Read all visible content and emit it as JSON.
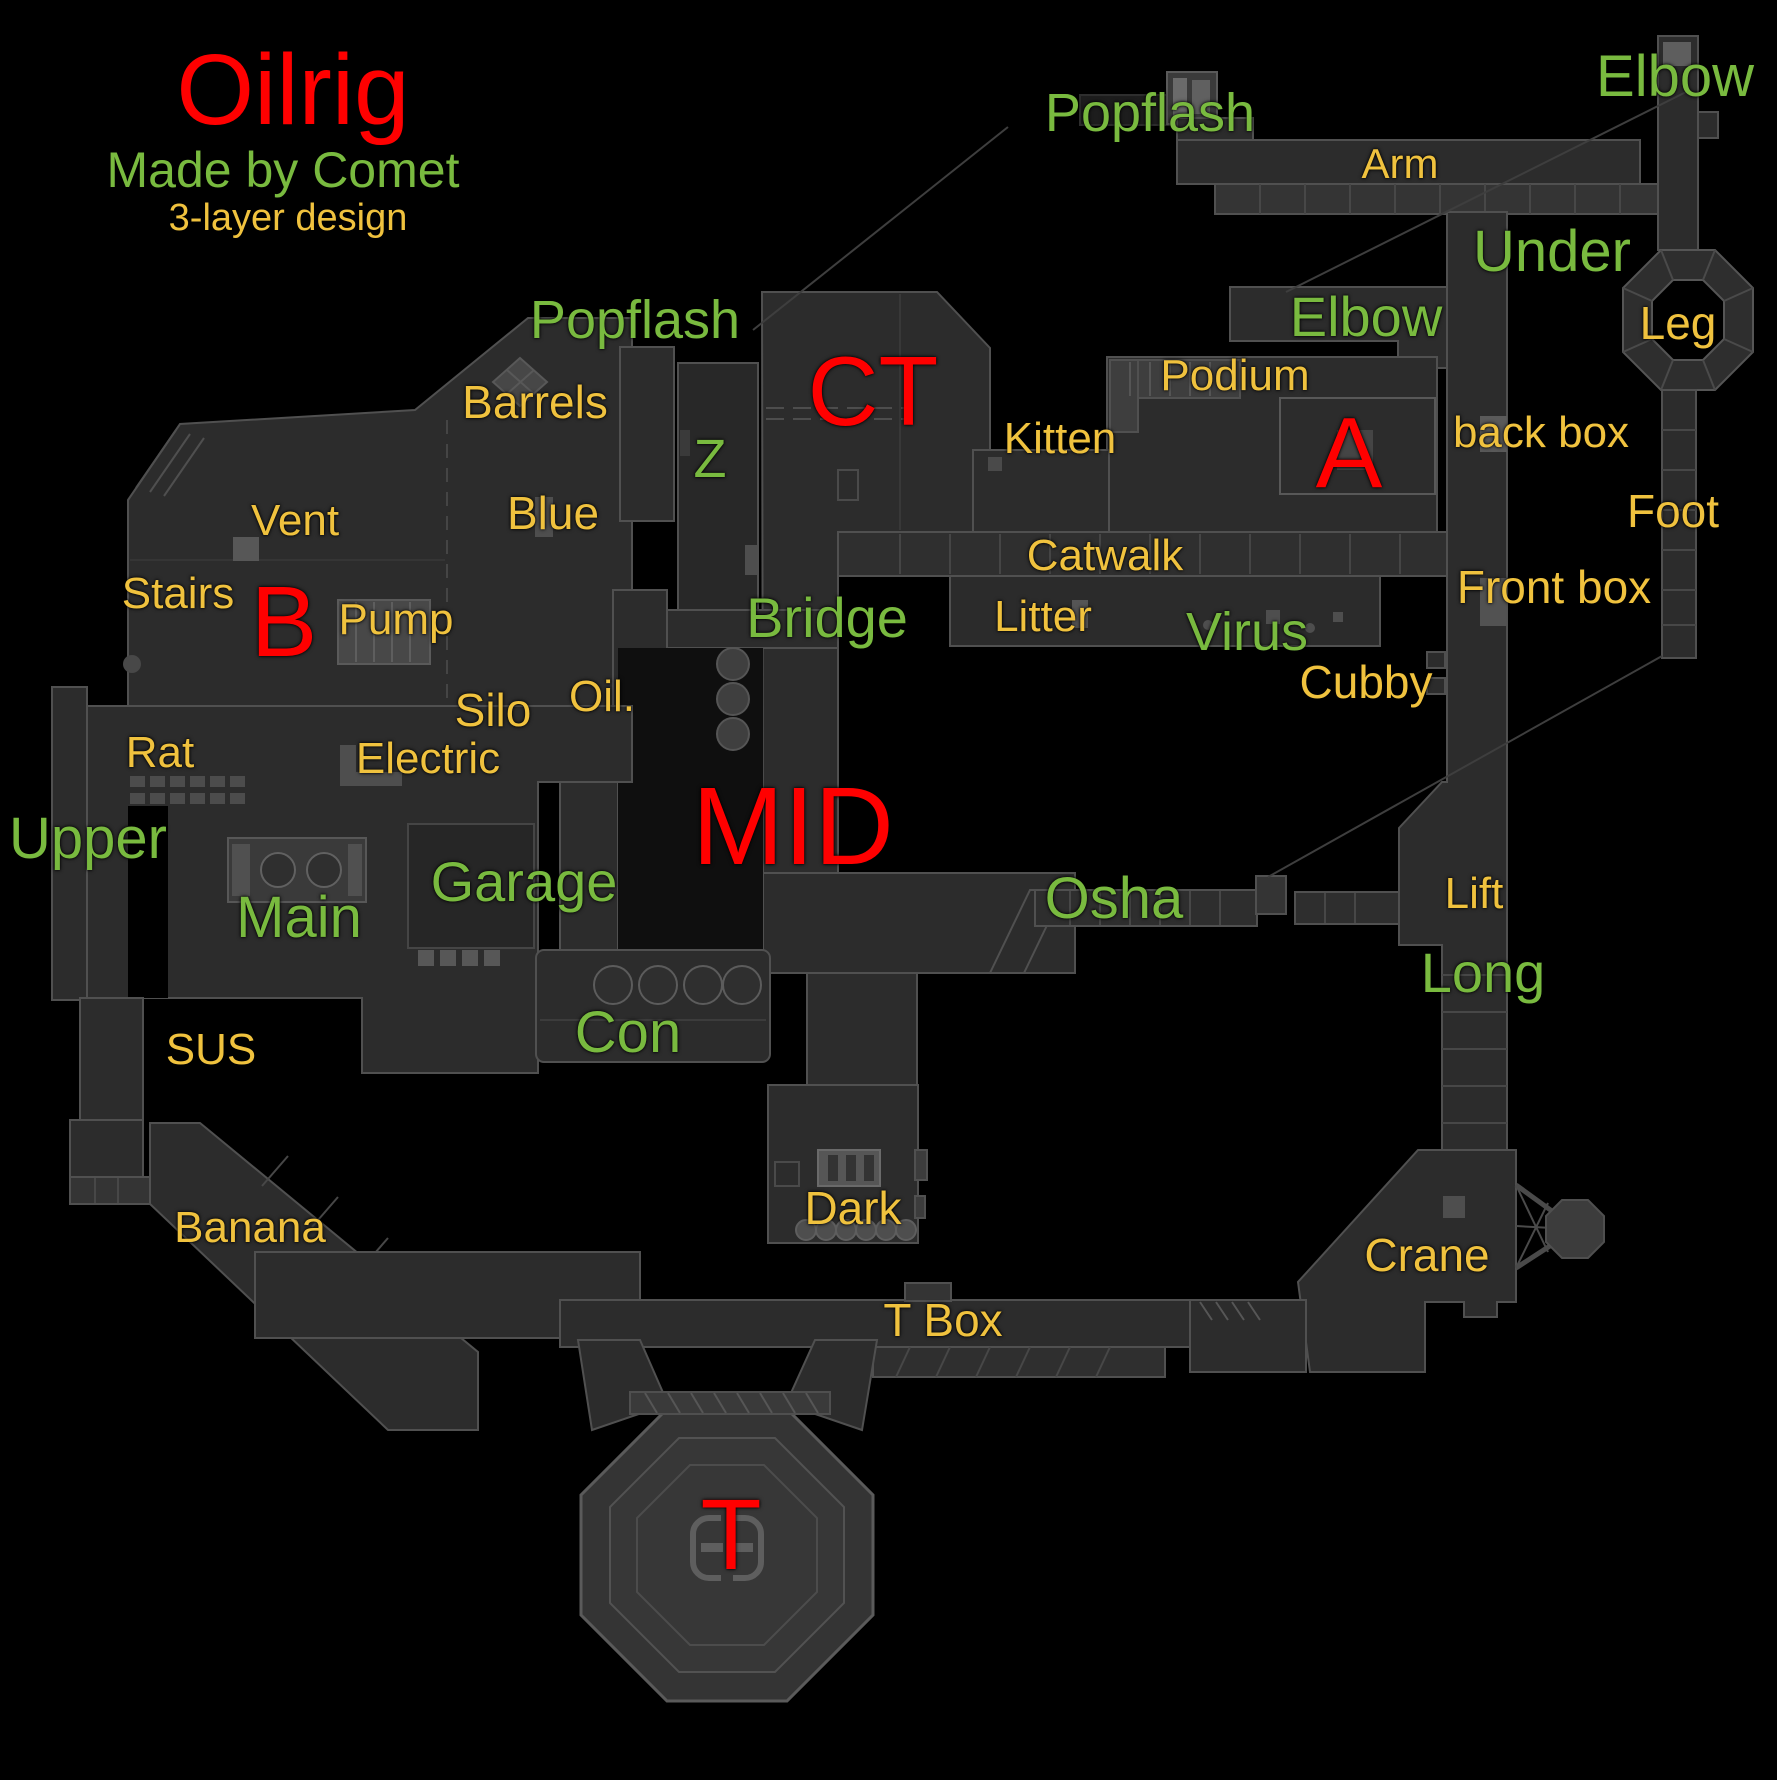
{
  "colors": {
    "red": "#FF0000",
    "green": "#79BA3F",
    "gold": "#F0C23E",
    "pointer_line": "#3E3E3E"
  },
  "labels": [
    {
      "id": "title",
      "text": "Oilrig",
      "color": "red",
      "x": 293,
      "y": 90,
      "size": 100
    },
    {
      "id": "credit",
      "text": "Made by Comet",
      "color": "green",
      "x": 283,
      "y": 170,
      "size": 50
    },
    {
      "id": "design-note",
      "text": "3-layer design",
      "color": "gold",
      "x": 288,
      "y": 218,
      "size": 38
    },
    {
      "id": "popflash-top",
      "text": "Popflash",
      "color": "green",
      "x": 1150,
      "y": 113,
      "size": 54
    },
    {
      "id": "arm",
      "text": "Arm",
      "color": "gold",
      "x": 1400,
      "y": 164,
      "size": 42
    },
    {
      "id": "elbow-top",
      "text": "Elbow",
      "color": "green",
      "x": 1675,
      "y": 77,
      "size": 58
    },
    {
      "id": "under",
      "text": "Under",
      "color": "green",
      "x": 1552,
      "y": 252,
      "size": 58
    },
    {
      "id": "leg",
      "text": "Leg",
      "color": "gold",
      "x": 1678,
      "y": 323,
      "size": 46
    },
    {
      "id": "elbow-a",
      "text": "Elbow",
      "color": "green",
      "x": 1366,
      "y": 317,
      "size": 56
    },
    {
      "id": "popflash-left",
      "text": "Popflash",
      "color": "green",
      "x": 635,
      "y": 320,
      "size": 54
    },
    {
      "id": "ct",
      "text": "CT",
      "color": "red",
      "x": 873,
      "y": 391,
      "size": 98
    },
    {
      "id": "podium",
      "text": "Podium",
      "color": "gold",
      "x": 1235,
      "y": 376,
      "size": 44
    },
    {
      "id": "kitten",
      "text": "Kitten",
      "color": "gold",
      "x": 1060,
      "y": 439,
      "size": 44
    },
    {
      "id": "a-site",
      "text": "A",
      "color": "red",
      "x": 1349,
      "y": 453,
      "size": 100
    },
    {
      "id": "back-box",
      "text": "back box",
      "color": "gold",
      "x": 1541,
      "y": 433,
      "size": 44
    },
    {
      "id": "foot",
      "text": "Foot",
      "color": "gold",
      "x": 1673,
      "y": 511,
      "size": 46
    },
    {
      "id": "z",
      "text": "Z",
      "color": "green",
      "x": 710,
      "y": 459,
      "size": 54
    },
    {
      "id": "barrels",
      "text": "Barrels",
      "color": "gold",
      "x": 535,
      "y": 402,
      "size": 46
    },
    {
      "id": "blue",
      "text": "Blue",
      "color": "gold",
      "x": 553,
      "y": 513,
      "size": 46
    },
    {
      "id": "vent",
      "text": "Vent",
      "color": "gold",
      "x": 295,
      "y": 521,
      "size": 44
    },
    {
      "id": "stairs",
      "text": "Stairs",
      "color": "gold",
      "x": 178,
      "y": 594,
      "size": 44
    },
    {
      "id": "b-site",
      "text": "B",
      "color": "red",
      "x": 284,
      "y": 622,
      "size": 100
    },
    {
      "id": "pump",
      "text": "Pump",
      "color": "gold",
      "x": 396,
      "y": 620,
      "size": 44
    },
    {
      "id": "catwalk",
      "text": "Catwalk",
      "color": "gold",
      "x": 1105,
      "y": 556,
      "size": 44
    },
    {
      "id": "litter",
      "text": "Litter",
      "color": "gold",
      "x": 1043,
      "y": 617,
      "size": 44
    },
    {
      "id": "virus",
      "text": "Virus",
      "color": "green",
      "x": 1247,
      "y": 632,
      "size": 54
    },
    {
      "id": "front-box",
      "text": "Front box",
      "color": "gold",
      "x": 1554,
      "y": 587,
      "size": 46
    },
    {
      "id": "bridge",
      "text": "Bridge",
      "color": "green",
      "x": 827,
      "y": 618,
      "size": 56
    },
    {
      "id": "cubby",
      "text": "Cubby",
      "color": "gold",
      "x": 1366,
      "y": 682,
      "size": 46
    },
    {
      "id": "silo",
      "text": "Silo",
      "color": "gold",
      "x": 493,
      "y": 710,
      "size": 46
    },
    {
      "id": "oil",
      "text": "Oil.",
      "color": "gold",
      "x": 602,
      "y": 697,
      "size": 44
    },
    {
      "id": "electric",
      "text": "Electric",
      "color": "gold",
      "x": 428,
      "y": 759,
      "size": 44
    },
    {
      "id": "rat",
      "text": "Rat",
      "color": "gold",
      "x": 160,
      "y": 753,
      "size": 44
    },
    {
      "id": "upper",
      "text": "Upper",
      "color": "green",
      "x": 88,
      "y": 839,
      "size": 58
    },
    {
      "id": "mid",
      "text": "MID",
      "color": "red",
      "x": 793,
      "y": 827,
      "size": 110
    },
    {
      "id": "garage",
      "text": "Garage",
      "color": "green",
      "x": 524,
      "y": 882,
      "size": 56
    },
    {
      "id": "main",
      "text": "Main",
      "color": "green",
      "x": 299,
      "y": 918,
      "size": 58
    },
    {
      "id": "osha",
      "text": "Osha",
      "color": "green",
      "x": 1114,
      "y": 899,
      "size": 58
    },
    {
      "id": "lift",
      "text": "Lift",
      "color": "gold",
      "x": 1474,
      "y": 894,
      "size": 44
    },
    {
      "id": "long",
      "text": "Long",
      "color": "green",
      "x": 1483,
      "y": 973,
      "size": 56
    },
    {
      "id": "con",
      "text": "Con",
      "color": "green",
      "x": 628,
      "y": 1033,
      "size": 58
    },
    {
      "id": "sus",
      "text": "SUS",
      "color": "gold",
      "x": 211,
      "y": 1050,
      "size": 44
    },
    {
      "id": "banana",
      "text": "Banana",
      "color": "gold",
      "x": 250,
      "y": 1228,
      "size": 44
    },
    {
      "id": "dark",
      "text": "Dark",
      "color": "gold",
      "x": 853,
      "y": 1208,
      "size": 46
    },
    {
      "id": "crane",
      "text": "Crane",
      "color": "gold",
      "x": 1427,
      "y": 1255,
      "size": 46
    },
    {
      "id": "t-box",
      "text": "T Box",
      "color": "gold",
      "x": 943,
      "y": 1320,
      "size": 46
    },
    {
      "id": "t-spawn",
      "text": "T",
      "color": "red",
      "x": 731,
      "y": 1535,
      "size": 100
    }
  ],
  "pointer_lines": [
    {
      "x1": 1008,
      "y1": 127,
      "x2": 753,
      "y2": 330
    },
    {
      "x1": 1686,
      "y1": 92,
      "x2": 1286,
      "y2": 292
    },
    {
      "x1": 1662,
      "y1": 656,
      "x2": 1268,
      "y2": 877
    }
  ]
}
